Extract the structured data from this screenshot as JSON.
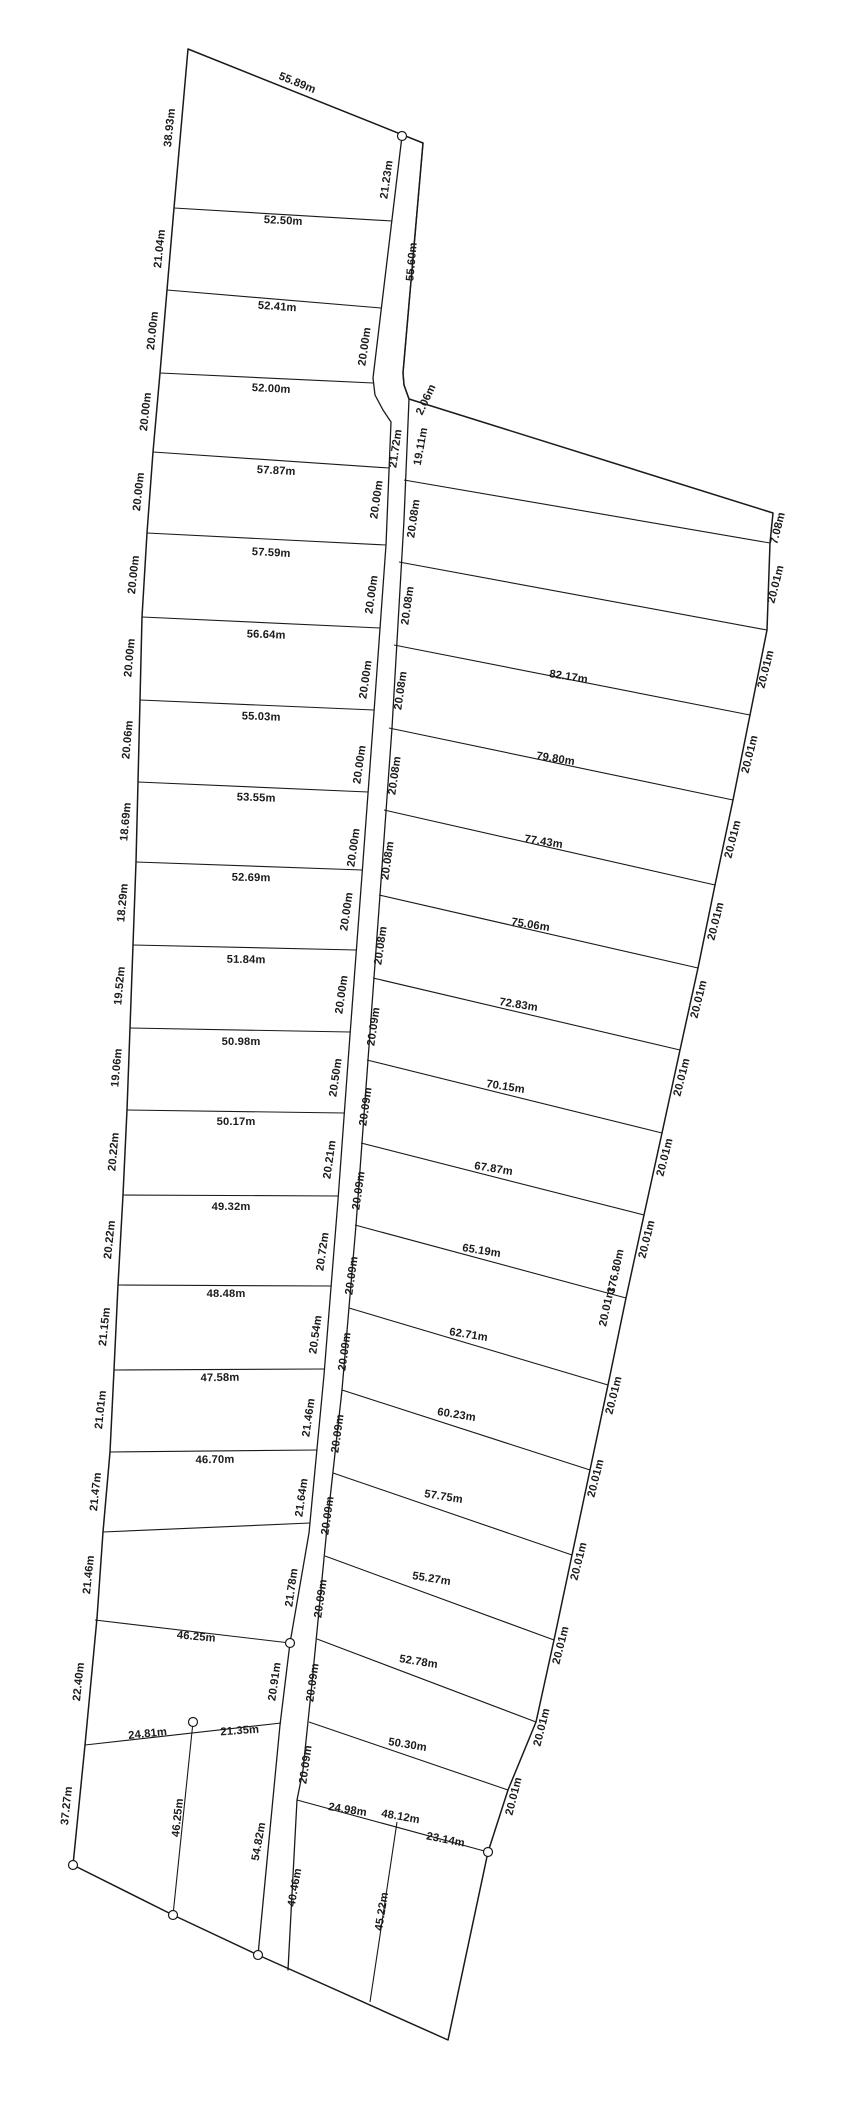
{
  "page": {
    "background": "#ffffff",
    "ink": "#1a1a1a",
    "canvas_width": 846,
    "canvas_height": 2126
  },
  "drawing": {
    "polylines": [
      {
        "name": "outer-boundary",
        "d": "M188,49 L423,143 L403,373 L404,385 L409,399 L773,513 L770,543 L767,630 L750,715 L733,800 L715,885 L698,968 L680,1050 L662,1133 L644,1215 L626,1298 L608,1385 L590,1470 L572,1555 L554,1640 L536,1722 L508,1790 L488,1852 L448,2040 L258,1955 L173,1915 L73,1865 L85,1745 L97,1618 L103,1532 L110,1452 L114,1370 L118,1285 L123,1195 L127,1110 L130,1028 L133,945 L136,862 L138,782 L140,700 L142,617 L147,533 L153,452 L160,373 L167,290 L174,208 Z",
        "width": 1.5
      },
      {
        "name": "road-west-line",
        "d": "M402,136 L373,378 L375,395 L383,410 L391,422 L386,545 L374,712 L362,875 L350,1035 L338,1200 L324,1375 L309,1533 L290,1643 L280,1725 L258,1955",
        "width": 1.3
      },
      {
        "name": "road-east-line",
        "d": "M423,143 L403,373 L404,385 L409,399 L404,520 L392,728 L380,895 L368,1060 L356,1225 L342,1390 L328,1517 L320,1600 L312,1683 L303,1770 L297,1800 L288,1970",
        "width": 1.3
      }
    ],
    "lot_lines": [
      {
        "x1": 174,
        "y1": 208,
        "x2": 392,
        "y2": 221
      },
      {
        "x1": 167,
        "y1": 290,
        "x2": 381,
        "y2": 308
      },
      {
        "x1": 160,
        "y1": 373,
        "x2": 373,
        "y2": 383
      },
      {
        "x1": 153,
        "y1": 452,
        "x2": 389,
        "y2": 468
      },
      {
        "x1": 147,
        "y1": 533,
        "x2": 386,
        "y2": 545
      },
      {
        "x1": 142,
        "y1": 617,
        "x2": 380,
        "y2": 628
      },
      {
        "x1": 140,
        "y1": 700,
        "x2": 374,
        "y2": 710
      },
      {
        "x1": 138,
        "y1": 782,
        "x2": 368,
        "y2": 792
      },
      {
        "x1": 136,
        "y1": 862,
        "x2": 362,
        "y2": 870
      },
      {
        "x1": 133,
        "y1": 945,
        "x2": 356,
        "y2": 950
      },
      {
        "x1": 130,
        "y1": 1028,
        "x2": 350,
        "y2": 1032
      },
      {
        "x1": 127,
        "y1": 1110,
        "x2": 344,
        "y2": 1113
      },
      {
        "x1": 123,
        "y1": 1195,
        "x2": 338,
        "y2": 1196
      },
      {
        "x1": 118,
        "y1": 1285,
        "x2": 331,
        "y2": 1286
      },
      {
        "x1": 114,
        "y1": 1370,
        "x2": 324,
        "y2": 1369
      },
      {
        "x1": 110,
        "y1": 1452,
        "x2": 317,
        "y2": 1450
      },
      {
        "x1": 103,
        "y1": 1532,
        "x2": 310,
        "y2": 1523
      },
      {
        "x1": 95,
        "y1": 1620,
        "x2": 290,
        "y2": 1643
      },
      {
        "x1": 85,
        "y1": 1745,
        "x2": 281,
        "y2": 1723
      },
      {
        "x1": 193,
        "y1": 1722,
        "x2": 173,
        "y2": 1915
      },
      {
        "x1": 404,
        "y1": 480,
        "x2": 770,
        "y2": 543
      },
      {
        "x1": 399,
        "y1": 562,
        "x2": 767,
        "y2": 630
      },
      {
        "x1": 394,
        "y1": 645,
        "x2": 750,
        "y2": 715
      },
      {
        "x1": 389,
        "y1": 728,
        "x2": 733,
        "y2": 800
      },
      {
        "x1": 384,
        "y1": 810,
        "x2": 715,
        "y2": 885
      },
      {
        "x1": 379,
        "y1": 895,
        "x2": 698,
        "y2": 968
      },
      {
        "x1": 373,
        "y1": 978,
        "x2": 680,
        "y2": 1050
      },
      {
        "x1": 367,
        "y1": 1060,
        "x2": 662,
        "y2": 1133
      },
      {
        "x1": 361,
        "y1": 1143,
        "x2": 644,
        "y2": 1215
      },
      {
        "x1": 355,
        "y1": 1225,
        "x2": 626,
        "y2": 1298
      },
      {
        "x1": 349,
        "y1": 1308,
        "x2": 608,
        "y2": 1385
      },
      {
        "x1": 342,
        "y1": 1390,
        "x2": 590,
        "y2": 1470
      },
      {
        "x1": 333,
        "y1": 1473,
        "x2": 572,
        "y2": 1555
      },
      {
        "x1": 325,
        "y1": 1556,
        "x2": 554,
        "y2": 1640
      },
      {
        "x1": 317,
        "y1": 1639,
        "x2": 536,
        "y2": 1722
      },
      {
        "x1": 309,
        "y1": 1722,
        "x2": 508,
        "y2": 1790
      },
      {
        "x1": 297,
        "y1": 1800,
        "x2": 488,
        "y2": 1852
      },
      {
        "x1": 397,
        "y1": 1822,
        "x2": 370,
        "y2": 2002
      }
    ],
    "markers": [
      {
        "x": 402,
        "y": 136
      },
      {
        "x": 290,
        "y": 1643
      },
      {
        "x": 193,
        "y": 1722
      },
      {
        "x": 73,
        "y": 1865
      },
      {
        "x": 173,
        "y": 1915
      },
      {
        "x": 258,
        "y": 1955
      },
      {
        "x": 488,
        "y": 1852
      }
    ],
    "labels": [
      {
        "t": "55.89m",
        "x": 296,
        "y": 86,
        "r": 22
      },
      {
        "t": "38.93m",
        "x": 173,
        "y": 128,
        "r": -84
      },
      {
        "t": "21.04m",
        "x": 163,
        "y": 249,
        "r": -84
      },
      {
        "t": "20.00m",
        "x": 156,
        "y": 331,
        "r": -84
      },
      {
        "t": "20.00m",
        "x": 149,
        "y": 412,
        "r": -84
      },
      {
        "t": "20.00m",
        "x": 142,
        "y": 492,
        "r": -84
      },
      {
        "t": "20.00m",
        "x": 137,
        "y": 575,
        "r": -84
      },
      {
        "t": "20.00m",
        "x": 133,
        "y": 658,
        "r": -85
      },
      {
        "t": "20.06m",
        "x": 131,
        "y": 740,
        "r": -85
      },
      {
        "t": "18.69m",
        "x": 129,
        "y": 822,
        "r": -85
      },
      {
        "t": "18.29m",
        "x": 126,
        "y": 903,
        "r": -85
      },
      {
        "t": "19.52m",
        "x": 123,
        "y": 986,
        "r": -85
      },
      {
        "t": "19.06m",
        "x": 120,
        "y": 1068,
        "r": -85
      },
      {
        "t": "20.22m",
        "x": 117,
        "y": 1152,
        "r": -85
      },
      {
        "t": "20.22m",
        "x": 113,
        "y": 1240,
        "r": -84
      },
      {
        "t": "21.15m",
        "x": 108,
        "y": 1327,
        "r": -84
      },
      {
        "t": "21.01m",
        "x": 104,
        "y": 1410,
        "r": -84
      },
      {
        "t": "21.47m",
        "x": 99,
        "y": 1492,
        "r": -84
      },
      {
        "t": "21.46m",
        "x": 92,
        "y": 1575,
        "r": -84
      },
      {
        "t": "22.40m",
        "x": 82,
        "y": 1682,
        "r": -84
      },
      {
        "t": "37.27m",
        "x": 70,
        "y": 1806,
        "r": -84
      },
      {
        "t": "52.50m",
        "x": 283,
        "y": 224,
        "r": 3
      },
      {
        "t": "52.41m",
        "x": 277,
        "y": 310,
        "r": 4
      },
      {
        "t": "52.00m",
        "x": 271,
        "y": 392,
        "r": 3
      },
      {
        "t": "57.87m",
        "x": 276,
        "y": 474,
        "r": 3
      },
      {
        "t": "57.59m",
        "x": 271,
        "y": 556,
        "r": 3
      },
      {
        "t": "56.64m",
        "x": 266,
        "y": 638,
        "r": 2
      },
      {
        "t": "55.03m",
        "x": 261,
        "y": 720,
        "r": 2
      },
      {
        "t": "53.55m",
        "x": 256,
        "y": 801,
        "r": 2
      },
      {
        "t": "52.69m",
        "x": 251,
        "y": 881,
        "r": 1
      },
      {
        "t": "51.84m",
        "x": 246,
        "y": 963,
        "r": 1
      },
      {
        "t": "50.98m",
        "x": 241,
        "y": 1045,
        "r": 0
      },
      {
        "t": "50.17m",
        "x": 236,
        "y": 1125,
        "r": 0
      },
      {
        "t": "49.32m",
        "x": 231,
        "y": 1210,
        "r": 0
      },
      {
        "t": "48.48m",
        "x": 226,
        "y": 1297,
        "r": 0
      },
      {
        "t": "47.58m",
        "x": 220,
        "y": 1381,
        "r": -1
      },
      {
        "t": "46.70m",
        "x": 215,
        "y": 1463,
        "r": -1
      },
      {
        "t": "46.25m",
        "x": 196,
        "y": 1640,
        "r": 5
      },
      {
        "t": "24.81m",
        "x": 148,
        "y": 1737,
        "r": -6
      },
      {
        "t": "21.35m",
        "x": 240,
        "y": 1734,
        "r": -4
      },
      {
        "t": "46.25m",
        "x": 181,
        "y": 1818,
        "r": -84
      },
      {
        "t": "21.23m",
        "x": 390,
        "y": 180,
        "r": -82
      },
      {
        "t": "20.00m",
        "x": 368,
        "y": 347,
        "r": -82
      },
      {
        "t": "21.72m",
        "x": 399,
        "y": 449,
        "r": -82
      },
      {
        "t": "20.00m",
        "x": 380,
        "y": 500,
        "r": -82
      },
      {
        "t": "20.00m",
        "x": 375,
        "y": 595,
        "r": -82
      },
      {
        "t": "20.00m",
        "x": 369,
        "y": 680,
        "r": -82
      },
      {
        "t": "20.00m",
        "x": 363,
        "y": 765,
        "r": -82
      },
      {
        "t": "20.00m",
        "x": 357,
        "y": 848,
        "r": -82
      },
      {
        "t": "20.00m",
        "x": 350,
        "y": 912,
        "r": -82
      },
      {
        "t": "20.00m",
        "x": 345,
        "y": 995,
        "r": -82
      },
      {
        "t": "20.50m",
        "x": 339,
        "y": 1078,
        "r": -82
      },
      {
        "t": "20.21m",
        "x": 333,
        "y": 1160,
        "r": -82
      },
      {
        "t": "20.72m",
        "x": 326,
        "y": 1252,
        "r": -82
      },
      {
        "t": "20.54m",
        "x": 319,
        "y": 1335,
        "r": -82
      },
      {
        "t": "21.46m",
        "x": 312,
        "y": 1418,
        "r": -82
      },
      {
        "t": "21.64m",
        "x": 305,
        "y": 1498,
        "r": -82
      },
      {
        "t": "21.78m",
        "x": 295,
        "y": 1588,
        "r": -82
      },
      {
        "t": "20.91m",
        "x": 278,
        "y": 1682,
        "r": -82
      },
      {
        "t": "54.82m",
        "x": 262,
        "y": 1842,
        "r": -80
      },
      {
        "t": "55.60m",
        "x": 415,
        "y": 262,
        "r": -85
      },
      {
        "t": "2.06m",
        "x": 429,
        "y": 401,
        "r": -65
      },
      {
        "t": "19.11m",
        "x": 424,
        "y": 447,
        "r": -80
      },
      {
        "t": "20.08m",
        "x": 417,
        "y": 519,
        "r": -82
      },
      {
        "t": "20.08m",
        "x": 411,
        "y": 606,
        "r": -82
      },
      {
        "t": "20.08m",
        "x": 404,
        "y": 691,
        "r": -82
      },
      {
        "t": "20.08m",
        "x": 398,
        "y": 776,
        "r": -82
      },
      {
        "t": "20.08m",
        "x": 391,
        "y": 861,
        "r": -82
      },
      {
        "t": "20.08m",
        "x": 384,
        "y": 946,
        "r": -82
      },
      {
        "t": "20.09m",
        "x": 377,
        "y": 1027,
        "r": -82
      },
      {
        "t": "20.09m",
        "x": 369,
        "y": 1107,
        "r": -82
      },
      {
        "t": "20.09m",
        "x": 362,
        "y": 1191,
        "r": -82
      },
      {
        "t": "20.09m",
        "x": 355,
        "y": 1276,
        "r": -82
      },
      {
        "t": "20.09m",
        "x": 348,
        "y": 1352,
        "r": -82
      },
      {
        "t": "20.09m",
        "x": 341,
        "y": 1434,
        "r": -82
      },
      {
        "t": "20.09m",
        "x": 331,
        "y": 1516,
        "r": -82
      },
      {
        "t": "20.09m",
        "x": 324,
        "y": 1599,
        "r": -82
      },
      {
        "t": "20.09m",
        "x": 316,
        "y": 1683,
        "r": -82
      },
      {
        "t": "20.09m",
        "x": 309,
        "y": 1765,
        "r": -82
      },
      {
        "t": "40.46m",
        "x": 298,
        "y": 1888,
        "r": -80
      },
      {
        "t": "82.17m",
        "x": 568,
        "y": 680,
        "r": 9
      },
      {
        "t": "79.80m",
        "x": 555,
        "y": 762,
        "r": 9
      },
      {
        "t": "77.43m",
        "x": 543,
        "y": 845,
        "r": 9
      },
      {
        "t": "75.06m",
        "x": 530,
        "y": 928,
        "r": 9
      },
      {
        "t": "72.83m",
        "x": 518,
        "y": 1008,
        "r": 9
      },
      {
        "t": "70.15m",
        "x": 505,
        "y": 1090,
        "r": 9
      },
      {
        "t": "67.87m",
        "x": 493,
        "y": 1172,
        "r": 9
      },
      {
        "t": "65.19m",
        "x": 481,
        "y": 1254,
        "r": 9
      },
      {
        "t": "62.71m",
        "x": 468,
        "y": 1338,
        "r": 9
      },
      {
        "t": "60.23m",
        "x": 456,
        "y": 1418,
        "r": 9
      },
      {
        "t": "57.75m",
        "x": 443,
        "y": 1500,
        "r": 9
      },
      {
        "t": "55.27m",
        "x": 431,
        "y": 1582,
        "r": 9
      },
      {
        "t": "52.78m",
        "x": 418,
        "y": 1665,
        "r": 9
      },
      {
        "t": "50.30m",
        "x": 407,
        "y": 1748,
        "r": 9
      },
      {
        "t": "24.98m",
        "x": 347,
        "y": 1813,
        "r": 9
      },
      {
        "t": "48.12m",
        "x": 400,
        "y": 1820,
        "r": 10
      },
      {
        "t": "23.14m",
        "x": 445,
        "y": 1843,
        "r": 11
      },
      {
        "t": "45.22m",
        "x": 385,
        "y": 1912,
        "r": -81
      },
      {
        "t": "7.08m",
        "x": 781,
        "y": 529,
        "r": -76
      },
      {
        "t": "20.01m",
        "x": 779,
        "y": 585,
        "r": -76
      },
      {
        "t": "20.01m",
        "x": 769,
        "y": 670,
        "r": -76
      },
      {
        "t": "20.01m",
        "x": 753,
        "y": 755,
        "r": -76
      },
      {
        "t": "20.01m",
        "x": 736,
        "y": 840,
        "r": -76
      },
      {
        "t": "20.01m",
        "x": 719,
        "y": 922,
        "r": -76
      },
      {
        "t": "20.01m",
        "x": 702,
        "y": 1000,
        "r": -76
      },
      {
        "t": "20.01m",
        "x": 685,
        "y": 1078,
        "r": -76
      },
      {
        "t": "20.01m",
        "x": 668,
        "y": 1158,
        "r": -76
      },
      {
        "t": "20.01m",
        "x": 650,
        "y": 1240,
        "r": -76
      },
      {
        "t": "376.80m",
        "x": 619,
        "y": 1272,
        "r": -78
      },
      {
        "t": "20.01m",
        "x": 610,
        "y": 1308,
        "r": -78
      },
      {
        "t": "20.01m",
        "x": 617,
        "y": 1396,
        "r": -76
      },
      {
        "t": "20.01m",
        "x": 599,
        "y": 1479,
        "r": -76
      },
      {
        "t": "20.01m",
        "x": 582,
        "y": 1562,
        "r": -76
      },
      {
        "t": "20.01m",
        "x": 564,
        "y": 1646,
        "r": -76
      },
      {
        "t": "20.01m",
        "x": 545,
        "y": 1728,
        "r": -76
      },
      {
        "t": "20.01m",
        "x": 517,
        "y": 1797,
        "r": -76
      }
    ]
  }
}
